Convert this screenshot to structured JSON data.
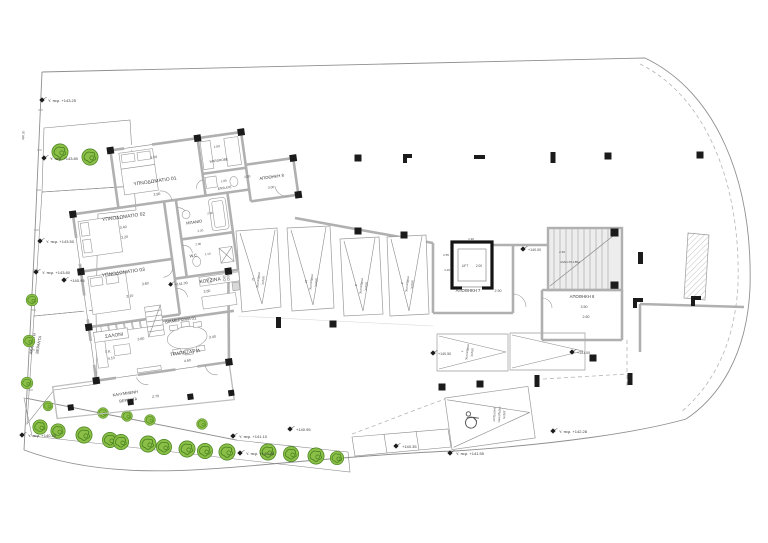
{
  "plan": {
    "unit_label": "ΔΙΑΜΕΡΙΣΜΑ 01",
    "rooms": {
      "bedroom1": {
        "name": "ΥΠΝΟΔΩΜΑΤΙΟ 01",
        "width": "4.00",
        "depth": "3.90"
      },
      "bedroom2": {
        "name": "ΥΠΝΟΔΩΜΑΤΙΟ 02",
        "width": "3.40",
        "depth": "3.20"
      },
      "bedroom3": {
        "name": "ΥΠΝΟΔΩΜΑΤΙΟ 03",
        "width": "3.60",
        "depth": "3.10"
      },
      "wardrobe": {
        "name": "WARDROBE",
        "width": "1.00"
      },
      "ensuite": {
        "name": "ENSUITE",
        "width": "1.80"
      },
      "bathroom": {
        "name": "ΜΠΑΝΙΟ",
        "width": "2.00",
        "depth": "2.20"
      },
      "wc": {
        "name": "W.C.",
        "width": "1.10",
        "depth": "2.00"
      },
      "kitchen": {
        "name": "ΚΟΥΖΙΝΑ",
        "level": "+141.00",
        "width": "3.50"
      },
      "living": {
        "name": "ΣΑΛΟΝΙ",
        "width": "3.60",
        "gk": "Γ.Κ.",
        "gk_dim": "4.10"
      },
      "dining": {
        "name": "ΤΡΑΠΕΖΑΡΙΑ",
        "width": "4.60",
        "depth": "3.40"
      }
    },
    "covered_veranda": {
      "line1": "ΚΑΛΥΜΜΕΝΗ",
      "line2": "ΒΕΡΑΝΤΑ",
      "dim": "2.70"
    },
    "open_veranda": {
      "line1": "ΑΚΑΛΥΠΤΗ",
      "line2": "ΒΕΡΑΝΤΑ"
    }
  },
  "core": {
    "lift": {
      "name": "LIFT",
      "dim": "2.00",
      "width": "1.90"
    },
    "stairs": {
      "width": "2.30",
      "note": "24ΑΝ.Χ0.185μ"
    },
    "storage6": {
      "name": "ΑΠΟΘΗΚΗ 6",
      "dim_a": "3.50",
      "dim_b": "2.60"
    },
    "storage7": {
      "name": "ΑΠΟΘΗΚΗ 7",
      "dim": "2.90",
      "dim_a": "4.15",
      "dim_b": "2.55"
    },
    "storage8": {
      "name": "ΑΠΟΘΗΚΗ 8",
      "dim_a": "2.50",
      "dim_b": "3.00"
    }
  },
  "parking": {
    "spots": [
      {
        "l1": "χώρος",
        "l2": "στάθμευσης",
        "num": "11"
      },
      {
        "l1": "χώρος",
        "l2": "στάθμευσης",
        "num": "10"
      },
      {
        "l1": "χώρος",
        "l2": "στάθμευσης",
        "num": "9"
      },
      {
        "l1": "χώρος",
        "l2": "στάθμευσης",
        "num": "8"
      },
      {
        "l1": "χώρος",
        "l2": "στάθμευσης",
        "num": "7"
      }
    ],
    "disabled": {
      "l1": "χώρος",
      "l2": "στάθμευσης",
      "l3": "αναπήρων"
    }
  },
  "levels": {
    "lift_lobby": "+140.00",
    "p7_left": "+140.50",
    "p7_right": "+141.00"
  },
  "site": {
    "boundary_dim": "350.20",
    "markers": [
      {
        "text": "Υ. περ. +143.25"
      },
      {
        "text": "Υ. περ. +143.80"
      },
      {
        "text": "Υ. περ. +143.50"
      },
      {
        "text": "Υ. περ. +143.80"
      },
      {
        "text": "+140.95"
      },
      {
        "text": "Υ. περ. +140.20"
      },
      {
        "text": "Υ. περ. +141.10"
      },
      {
        "text": "Υ. περ. +140.46"
      },
      {
        "text": "+140.95"
      },
      {
        "text": "+140.35"
      },
      {
        "text": "Υ. περ. +141.55"
      },
      {
        "text": "Υ. περ. +142.28"
      }
    ]
  },
  "colors": {
    "wall_gray": "#b0b0b0",
    "column_black": "#1b1b1b",
    "tree_light": "#8cbf47",
    "tree_dark": "#45801f",
    "line_gray": "#8f8f8f"
  }
}
